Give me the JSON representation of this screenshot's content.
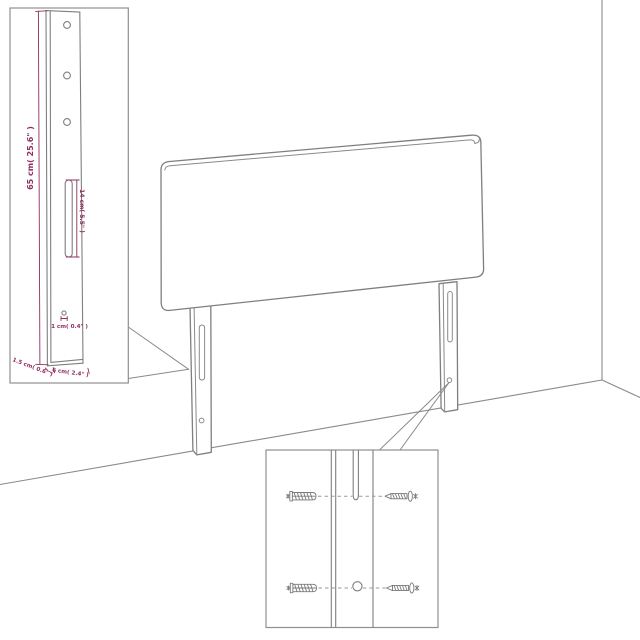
{
  "diagram": {
    "title": "headboard wall-mounting assembly diagram",
    "background": "#ffffff",
    "colors": {
      "linework": "#7f7f7f",
      "inset_border": "#8f8f8f",
      "dimension_accent": "#8e2f5e"
    },
    "dimension_labels": {
      "leg_height": "65 cm( 25.6\" )",
      "slot_length": "14 cm( 5.5\" )",
      "hole_diameter": "1 cm( 0.4\" )",
      "leg_thickness": "1.5 cm( 0.6\" )",
      "leg_width": "6 cm( 2.4\" )"
    },
    "icons": {
      "wall_plug": "wall-plug-icon",
      "screw": "screw-icon"
    },
    "counts": {
      "leg_top_holes": 3,
      "hardware_rows": 2
    }
  }
}
